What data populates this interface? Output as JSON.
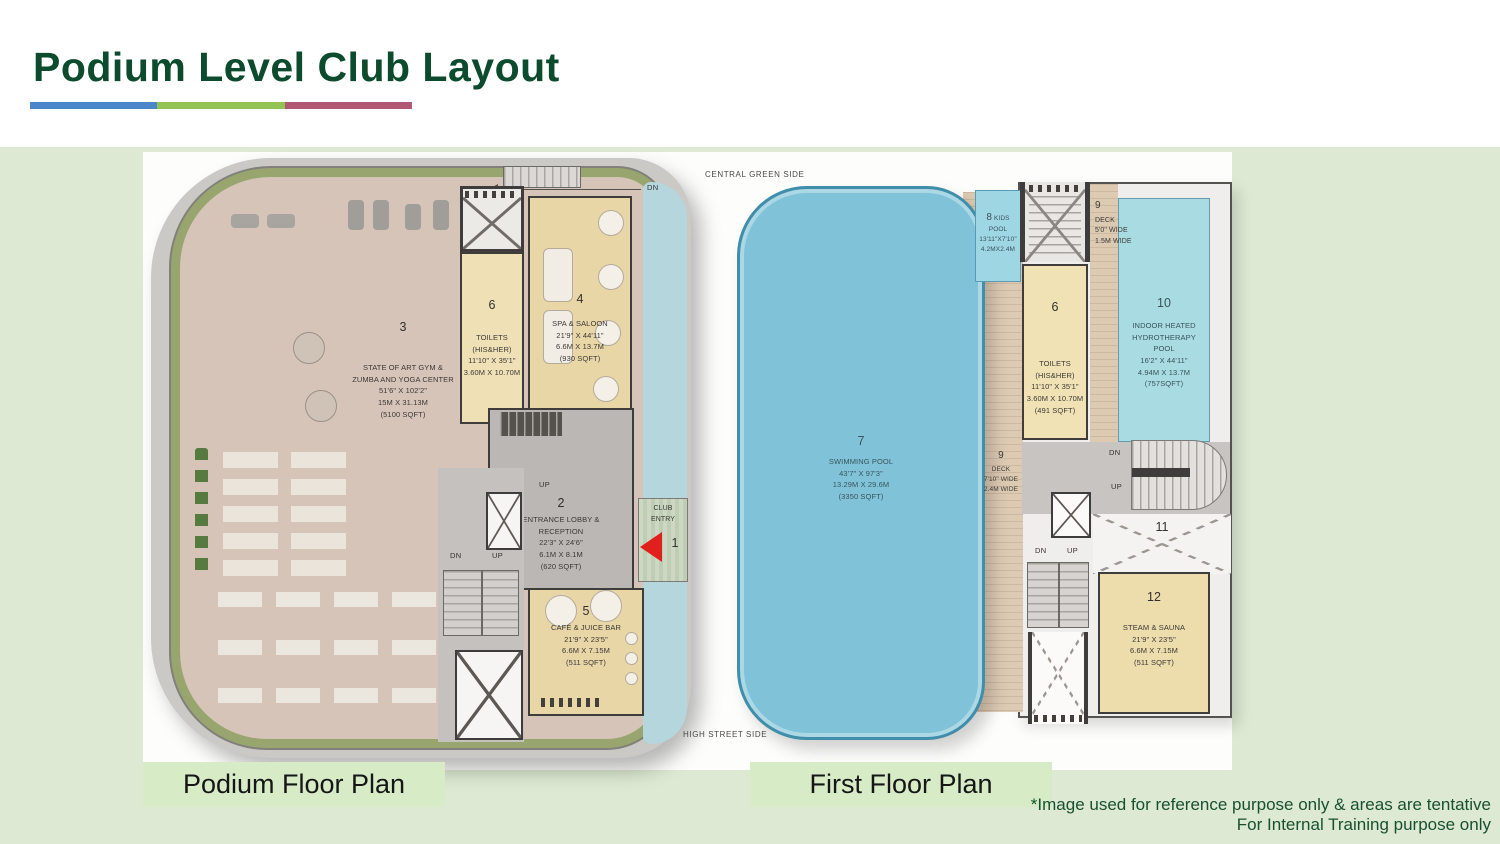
{
  "slide": {
    "title": "Podium Level Club Layout",
    "footnote_line1": "*Image used for reference purpose only & areas are tentative",
    "footnote_line2": "For Internal Training purpose only",
    "accent_colors": {
      "blue": "#4a86c8",
      "green": "#93c353",
      "maroon": "#b05874"
    },
    "title_color": "#0d4b2e"
  },
  "captions": {
    "podium": "Podium Floor Plan",
    "first": "First Floor Plan"
  },
  "site": {
    "top_label": "CENTRAL GREEN SIDE",
    "bottom_label": "HIGH STREET SIDE"
  },
  "podium_plan": {
    "dn": "DN",
    "gym": {
      "num": "3",
      "name1": "STATE OF ART GYM &",
      "name2": "ZUMBA AND YOGA CENTER",
      "dim_ft": "51'6\" X 102'2\"",
      "dim_m": "15M X 31.13M",
      "area": "(5100 SQFT)"
    },
    "toilets": {
      "num": "6",
      "name1": "TOILETS",
      "name2": "(HIS&HER)",
      "dim_ft": "11'10\" X 35'1\"",
      "dim_m": "3.60M X 10.70M"
    },
    "spa": {
      "num": "4",
      "name1": "SPA & SALOON",
      "dim_ft": "21'9\" X 44'11\"",
      "dim_m": "6.6M X 13.7M",
      "area": "(930 SQFT)"
    },
    "lobby": {
      "num": "2",
      "up": "UP",
      "name1": "ENTRANCE LOBBY &",
      "name2": "RECEPTION",
      "dim_ft": "22'3\" X 24'6\"",
      "dim_m": "6.1M X 8.1M",
      "area": "(620 SQFT)"
    },
    "cafe": {
      "num": "5",
      "name1": "CAFÉ & JUICE BAR",
      "dim_ft": "21'9\" X 23'5\"",
      "dim_m": "6.6M X 7.15M",
      "area": "(511 SQFT)"
    },
    "entry": {
      "num": "1",
      "name1": "CLUB",
      "name2": "ENTRY"
    },
    "stairs": {
      "dn": "DN",
      "up": "UP"
    }
  },
  "first_plan": {
    "pool": {
      "num": "7",
      "name1": "SWIMMING POOL",
      "dim_ft": "43'7\" X 97'3\"",
      "dim_m": "13.29M X 29.6M",
      "area": "(3350 SQFT)"
    },
    "kids_pool": {
      "num": "8",
      "name1": "KIDS",
      "name2": "POOL",
      "dim_ft": "13'11\"X7'10\"",
      "dim_m": "4.2MX2.4M"
    },
    "deck_top": {
      "num": "9",
      "name1": "DECK",
      "dim1": "5'0\" WIDE",
      "dim2": "1.5M WIDE"
    },
    "deck_side": {
      "num": "9",
      "name1": "DECK",
      "dim1": "7'10\" WIDE",
      "dim2": "2.4M WIDE"
    },
    "hydro": {
      "num": "10",
      "name1": "INDOOR HEATED",
      "name2": "HYDROTHERAPY",
      "name3": "POOL",
      "dim_ft": "16'2\" X 44'11\"",
      "dim_m": "4.94M X 13.7M",
      "area": "(757SQFT)"
    },
    "toilets": {
      "num": "6",
      "name1": "TOILETS",
      "name2": "(HIS&HER)",
      "dim_ft": "11'10\" X 35'1\"",
      "dim_m": "3.60M X 10.70M",
      "area": "(491 SQFT)"
    },
    "void": {
      "num": "11"
    },
    "sauna": {
      "num": "12",
      "name1": "STEAM & SAUNA",
      "dim_ft": "21'9\" X 23'5\"",
      "dim_m": "6.6M X 7.15M",
      "area": "(511 SQFT)"
    },
    "stair_top": {
      "dn": "DN",
      "up": "UP"
    },
    "stair_bottom": {
      "dn": "DN",
      "up": "UP"
    }
  }
}
